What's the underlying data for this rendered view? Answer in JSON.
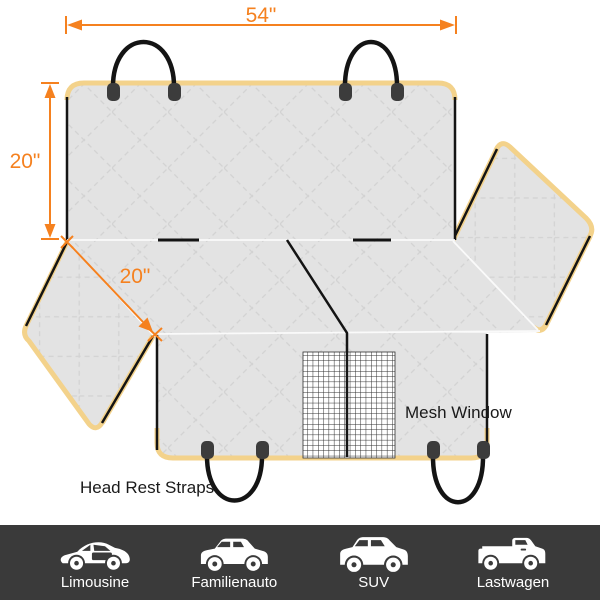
{
  "diagram": {
    "width_dim": "54\"",
    "height_dim": "20\"",
    "flap_dim": "20\"",
    "mesh_window_label": "Mesh Window",
    "head_rest_straps_label": "Head Rest Straps",
    "colors": {
      "dimension_orange": "#F5811F",
      "trim_yellow": "#F3D28B",
      "fabric_gray": "#E3E3E3",
      "quilt_line": "#D3D3D3",
      "strap_black": "#141414",
      "grommet_gray": "#3C3C3C",
      "footer_bg": "#3A3A3A"
    }
  },
  "footer": {
    "items": [
      {
        "label": "Limousine",
        "icon": "sedan-car-icon"
      },
      {
        "label": "Familienauto",
        "icon": "family-car-icon"
      },
      {
        "label": "SUV",
        "icon": "suv-car-icon"
      },
      {
        "label": "Lastwagen",
        "icon": "pickup-truck-icon"
      }
    ]
  }
}
